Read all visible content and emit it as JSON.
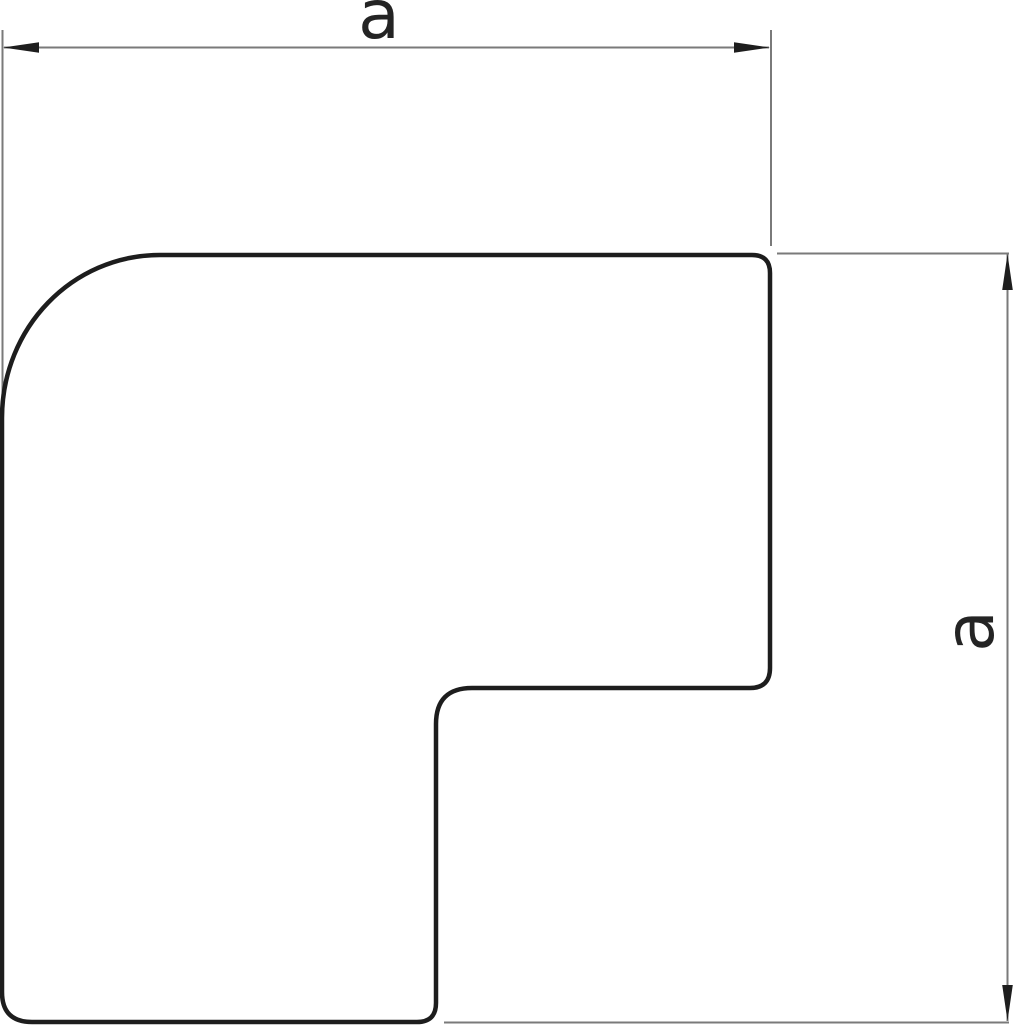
{
  "drawing": {
    "dimensions": {
      "width_label": "a",
      "height_label": "a"
    },
    "colors": {
      "outline": "#1d1d1d",
      "fill": "#ffffff",
      "dimension_line": "#7a7a7a",
      "extension_line": "#7a7a7a",
      "arrow": "#1e1e1e",
      "label": "#242424",
      "background": "#ffffff"
    }
  }
}
